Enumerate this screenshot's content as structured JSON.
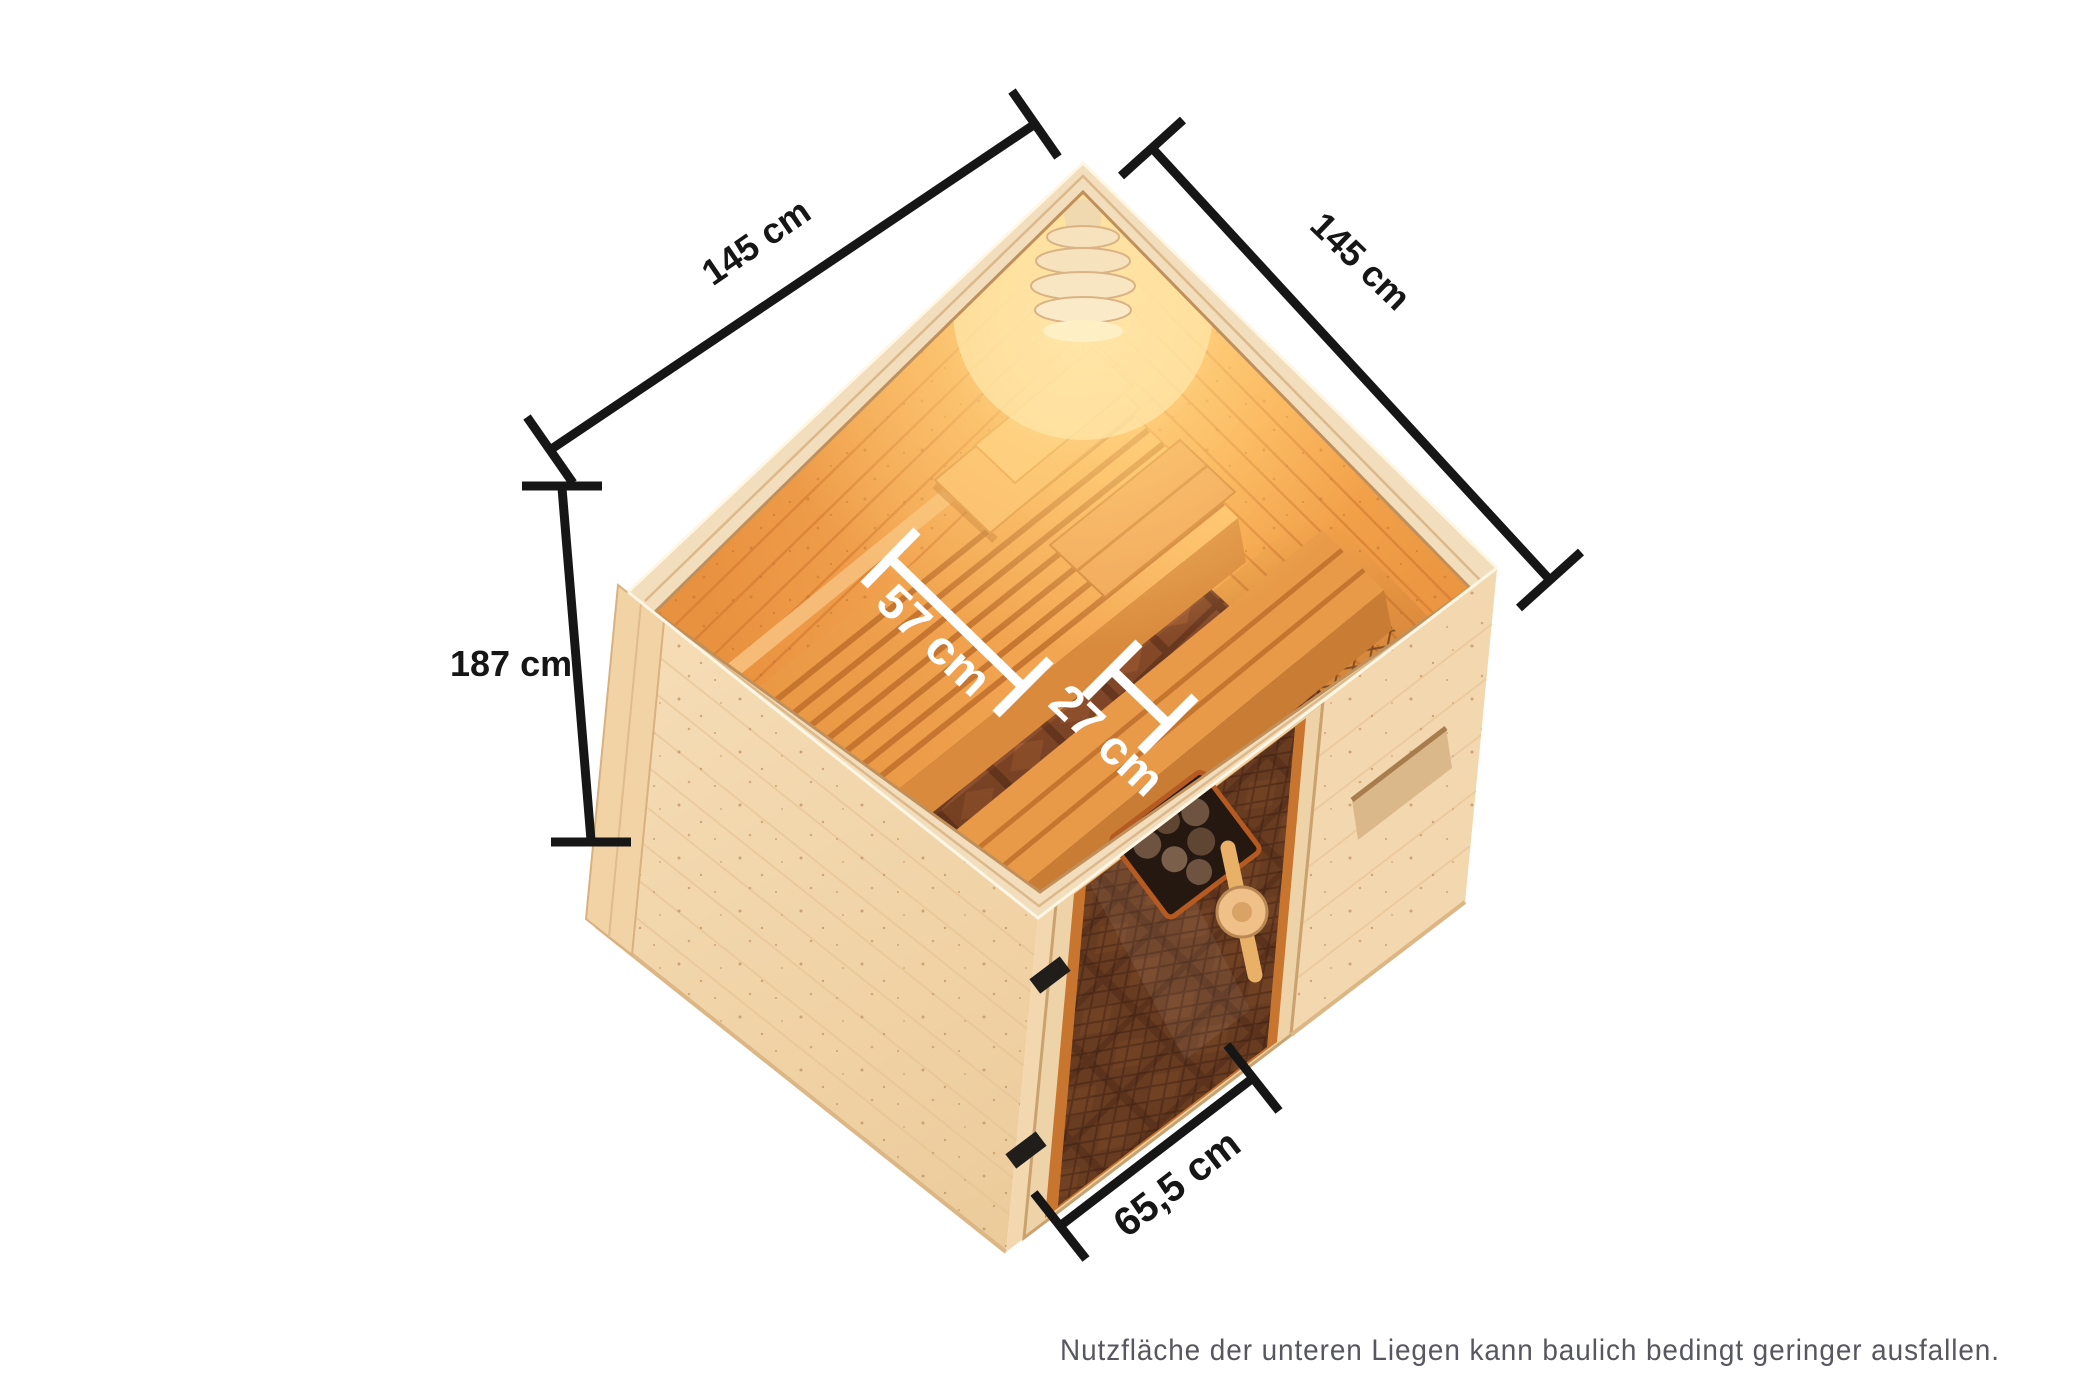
{
  "dimensions": {
    "left_width": "145 cm",
    "right_width": "145 cm",
    "height": "187 cm",
    "upper_bench_depth": "57 cm",
    "lower_bench_depth": "27 cm",
    "door_width": "65,5 cm"
  },
  "note": {
    "text": "Nutzfläche der unteren Liegen kann baulich bedingt geringer ausfallen."
  },
  "colors": {
    "background": "#ffffff",
    "dimension_line": "#161616",
    "interior_label": "#ffffff",
    "note_text": "#57575f",
    "exterior_wood": "#f3d8af",
    "interior_wood_lit": "#ffc679",
    "interior_wood_shadow": "#e8913e",
    "bench_groove": "#bf6f2b",
    "floor_tile": "#8d4f2d",
    "door_glass": "#4a2c18",
    "lamp_glow": "#ffe3a0"
  }
}
